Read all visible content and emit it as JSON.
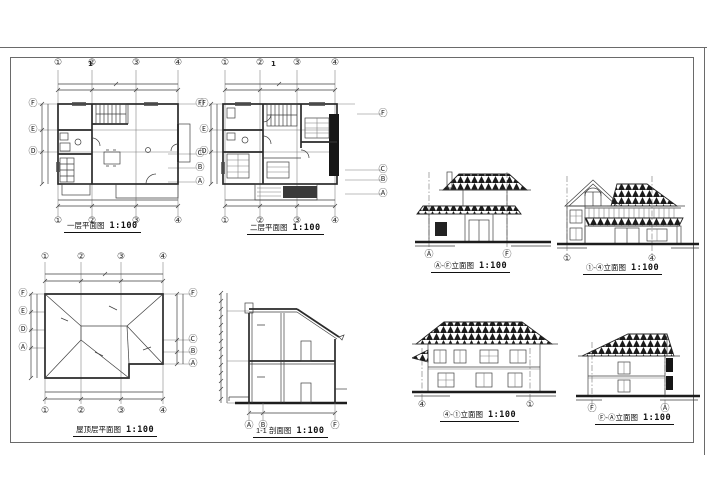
{
  "sheet": {
    "background": "#ffffff",
    "line_color": "#6a6a6a",
    "ink_color": "#2a2a2a",
    "roof_hatch_color": "#161616"
  },
  "drawings": {
    "plan1": {
      "title": "一层平面图",
      "scale": "1:100",
      "section_marker": "1",
      "axes_top": [
        "①",
        "②",
        "③",
        "④"
      ],
      "axes_bottom": [
        "①",
        "②",
        "③",
        "④"
      ],
      "axes_left": [
        "Ⓕ",
        "Ⓔ",
        "Ⓓ"
      ],
      "axes_right": [
        "Ⓕ",
        "Ⓒ",
        "Ⓑ",
        "Ⓐ"
      ]
    },
    "plan2": {
      "title": "二层平面图",
      "scale": "1:100",
      "section_marker": "1",
      "axes_top": [
        "①",
        "②",
        "③",
        "④"
      ],
      "axes_bottom": [
        "①",
        "②",
        "③",
        "④"
      ],
      "axes_left": [
        "Ⓕ",
        "Ⓔ",
        "Ⓓ"
      ],
      "axes_right": [
        "Ⓕ",
        "Ⓒ",
        "Ⓑ",
        "Ⓐ"
      ]
    },
    "roof": {
      "title": "屋顶层平面图",
      "scale": "1:100",
      "axes_top": [
        "①",
        "②",
        "③",
        "④"
      ],
      "axes_bottom": [
        "①",
        "②",
        "③",
        "④"
      ],
      "axes_left": [
        "Ⓕ",
        "Ⓔ",
        "Ⓓ",
        "Ⓐ"
      ],
      "axes_right": [
        "Ⓕ",
        "Ⓒ",
        "Ⓑ",
        "Ⓐ"
      ]
    },
    "section": {
      "title": "1-1 剖面图",
      "scale": "1:100",
      "axes_bottom": [
        "Ⓐ",
        "Ⓑ",
        "Ⓕ"
      ]
    },
    "elev_af": {
      "title": "Ⓐ-Ⓕ立面图",
      "scale": "1:100",
      "axes_bottom": [
        "Ⓐ",
        "Ⓕ"
      ]
    },
    "elev_14": {
      "title": "①-④立面图",
      "scale": "1:100",
      "axes_bottom": [
        "①",
        "④"
      ]
    },
    "elev_41": {
      "title": "④-①立面图",
      "scale": "1:100",
      "axes_bottom": [
        "④",
        "①"
      ]
    },
    "elev_fa": {
      "title": "Ⓕ-Ⓐ立面图",
      "scale": "1:100",
      "axes_bottom": [
        "Ⓕ",
        "Ⓐ"
      ]
    }
  }
}
